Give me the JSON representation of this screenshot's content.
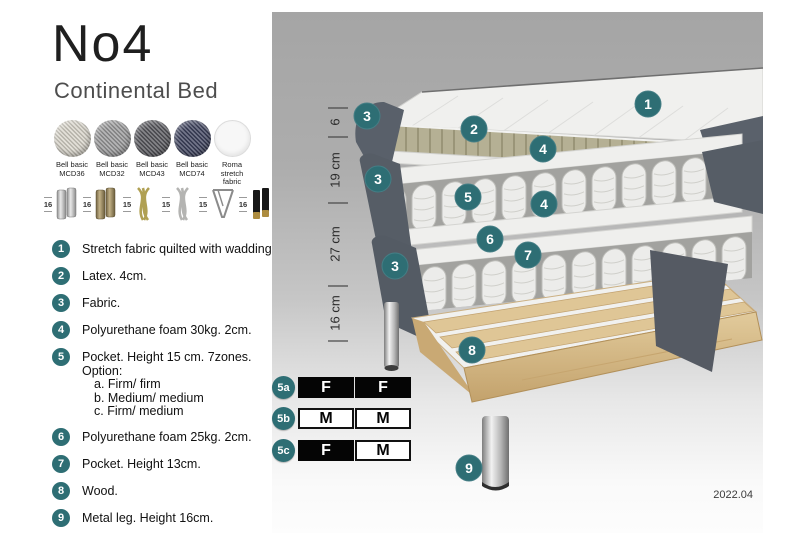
{
  "title": "No4",
  "subtitle": "Continental Bed",
  "fabrics": [
    {
      "name": "Bell basic",
      "code": "MCD36",
      "color": "#d8d4c9"
    },
    {
      "name": "Bell basic",
      "code": "MCD32",
      "color": "#99999a"
    },
    {
      "name": "Bell basic",
      "code": "MCD43",
      "color": "#55555a"
    },
    {
      "name": "Bell basic",
      "code": "MCD74",
      "color": "#3b405c"
    },
    {
      "name": "Roma",
      "code": "stretch fabric",
      "color": "#f7f7f7"
    }
  ],
  "legs": [
    {
      "height": "16",
      "type": "chrome cylinder leg"
    },
    {
      "height": "16",
      "type": "brass cylinder leg"
    },
    {
      "height": "15",
      "type": "gold twist leg"
    },
    {
      "height": "15",
      "type": "silver twist leg"
    },
    {
      "height": "15",
      "type": "hairpin leg"
    },
    {
      "height": "16",
      "type": "black leg with brass tip"
    }
  ],
  "parts": [
    {
      "num": "1",
      "text": "Stretch fabric quilted with wadding."
    },
    {
      "num": "2",
      "text": "Latex. 4cm."
    },
    {
      "num": "3",
      "text": "Fabric."
    },
    {
      "num": "4",
      "text": "Polyurethane foam 30kg. 2cm."
    },
    {
      "num": "5",
      "text": "Pocket. Height 15 cm. 7zones. Option:",
      "options": [
        "a. Firm/ firm",
        "b. Medium/ medium",
        "c. Firm/ medium"
      ]
    },
    {
      "num": "6",
      "text": "Polyurethane foam 25kg. 2cm."
    },
    {
      "num": "7",
      "text": "Pocket. Height 13cm."
    },
    {
      "num": "8",
      "text": "Wood."
    },
    {
      "num": "9",
      "text": "Metal leg. Height 16cm."
    }
  ],
  "dimensions": [
    "6",
    "19 cm",
    "27 cm",
    "16 cm"
  ],
  "firmness_options": [
    {
      "label": "5a",
      "cells": [
        {
          "letter": "F",
          "style": "dark"
        },
        {
          "letter": "F",
          "style": "dark"
        }
      ]
    },
    {
      "label": "5b",
      "cells": [
        {
          "letter": "M",
          "style": "light"
        },
        {
          "letter": "M",
          "style": "light"
        }
      ]
    },
    {
      "label": "5c",
      "cells": [
        {
          "letter": "F",
          "style": "dark"
        },
        {
          "letter": "M",
          "style": "light"
        }
      ]
    }
  ],
  "version": "2022.04",
  "colors": {
    "accent_teal": "#2e6e74",
    "panel_gray_top": "#a5a5a5",
    "fabric_dark_gray": "#59606a",
    "latex_tan": "#b5b094",
    "wood": "#ddc494",
    "spring_white": "#ececea"
  }
}
